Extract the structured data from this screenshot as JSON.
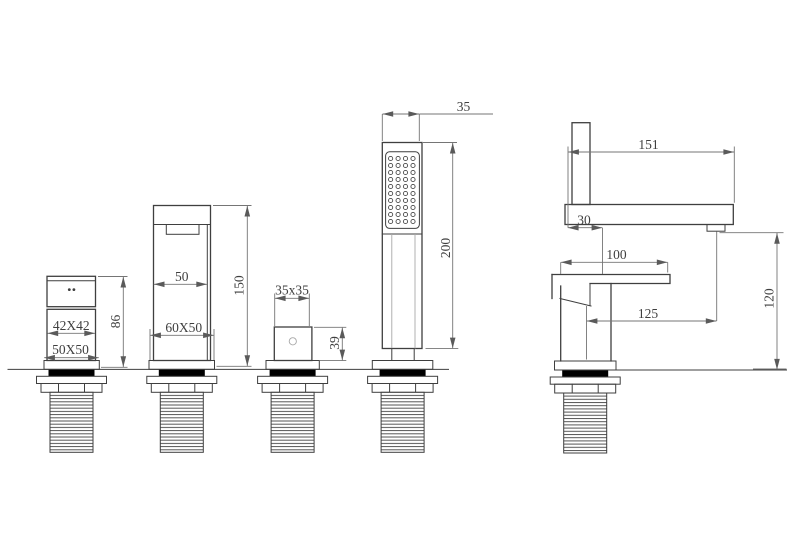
{
  "drawing": {
    "colors": {
      "background": "#ffffff",
      "object_line": "#3f3f3f",
      "dimension_line": "#757575",
      "label_text": "#3f3f3f",
      "seal_fill": "#000000"
    },
    "views": {
      "spout_small": {
        "label_top": "42X42",
        "label_base": "50X50",
        "label_height": "86"
      },
      "spout_tall": {
        "label_inner": "50",
        "label_base": "60X50",
        "label_height": "150"
      },
      "diverter": {
        "label_top": "35x35",
        "label_height": "39"
      },
      "hand_shower": {
        "label_width": "35",
        "label_height": "200"
      },
      "mixer_side": {
        "label_reach": "151",
        "label_offset": "30",
        "label_handle": "100",
        "label_outlet": "125",
        "label_height": "120"
      }
    }
  }
}
